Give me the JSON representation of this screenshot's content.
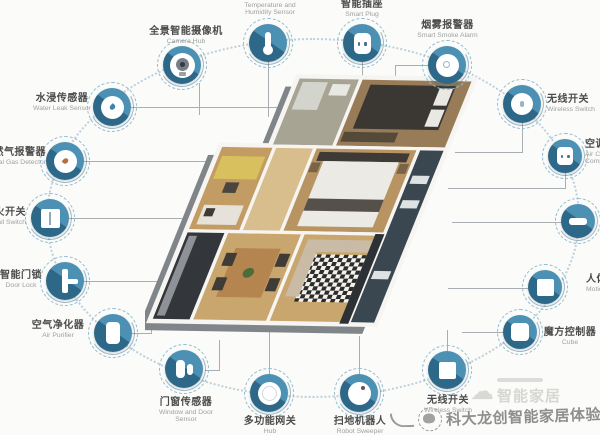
{
  "title": "smart home devices around 3d floor plan",
  "colors": {
    "node_blue": "#4c90b3",
    "node_blue_dark": "#2e6888",
    "halo_dashed": "#93bdd2",
    "ring_dotted": "#bdd0da",
    "line_gray": "#a9aeb2",
    "label_zh": "#4c4c4c",
    "label_en": "#a0a0a0",
    "background": "#fbfbf9"
  },
  "nodes": {
    "camera": {
      "zh": "全景智能摄像机",
      "en": "Camera Hub",
      "icon": "camera-icon"
    },
    "temp": {
      "zh": "温湿度传感器",
      "en": "Temperature and",
      "en2": "Humidity Sensor",
      "icon": "thermometer-icon"
    },
    "plug": {
      "zh": "智能插座",
      "en": "Smart Plug",
      "icon": "power-socket-icon"
    },
    "smoke": {
      "zh": "烟雾报警器",
      "en": "Smart Smoke Alarm",
      "icon": "smoke-detector-icon"
    },
    "wswR": {
      "zh": "无线开关",
      "en": "Wireless Switch",
      "icon": "round-button-icon"
    },
    "acp": {
      "zh": "空调伴侣",
      "en": "Air Conditioner",
      "en2": "Companion",
      "icon": "socket-icon"
    },
    "bar": {
      "icon": "bar-device-icon"
    },
    "motion": {
      "zh": "人体传感器",
      "en": "Motion Sensor",
      "icon": "square-sensor-icon"
    },
    "cube": {
      "zh": "魔方控制器",
      "en": "Cube",
      "icon": "cube-icon"
    },
    "wswB": {
      "zh": "无线开关",
      "en": "Wireless Switch",
      "icon": "square-switch-icon"
    },
    "robot": {
      "zh": "扫地机器人",
      "en": "Robot Sweeper",
      "icon": "robot-vacuum-icon"
    },
    "hub": {
      "zh": "多功能网关",
      "en": "Hub",
      "icon": "gateway-ring-icon"
    },
    "dw": {
      "zh": "门窗传感器",
      "en": "Window and Door",
      "en2": "Sensor",
      "icon": "door-window-sensor-icon"
    },
    "purifier": {
      "zh": "空气净化器",
      "en": "Air Purifier",
      "icon": "air-purifier-icon"
    },
    "lock": {
      "zh": "智能门锁",
      "en": "Door Lock",
      "icon": "door-lock-icon"
    },
    "wallsw": {
      "zh": "零火开关",
      "en": "Wall Switch",
      "icon": "wall-switch-icon"
    },
    "gas": {
      "zh": "天然气报警器",
      "en": "Natural Gas Detector",
      "icon": "gas-detector-icon"
    },
    "water": {
      "zh": "水浸传感器",
      "en": "Water Leak Sensor",
      "icon": "water-leak-icon"
    }
  },
  "watermarks": {
    "light_main": "智能家居",
    "dark_text": "科大龙创智能家居体验"
  }
}
